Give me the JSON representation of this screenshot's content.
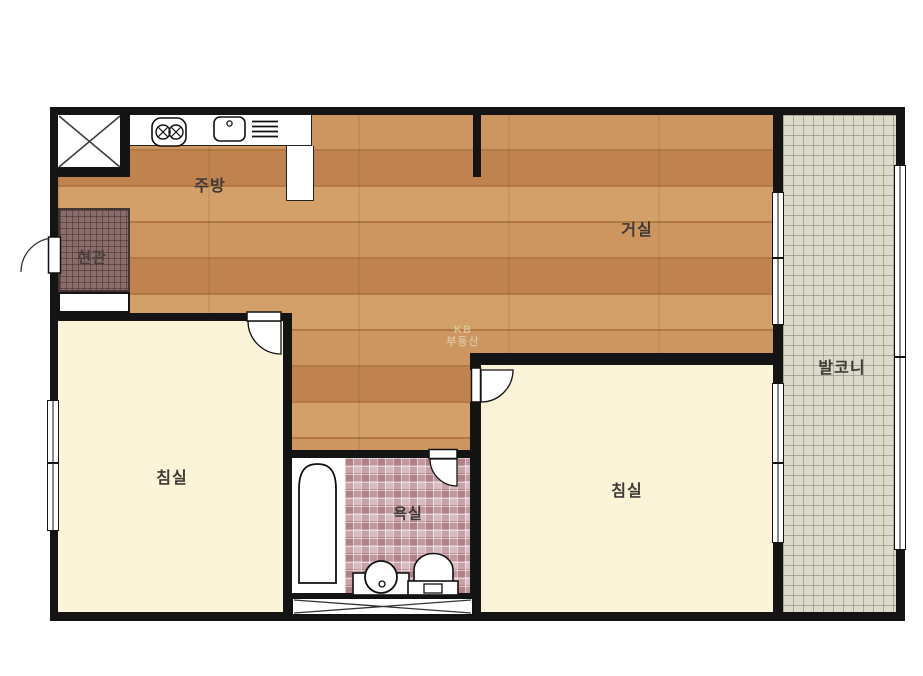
{
  "plan": {
    "rooms": {
      "kitchen": "주방",
      "living": "거실",
      "entrance": "현관",
      "bedroom_left": "침실",
      "bedroom_right": "침실",
      "bathroom": "욕실",
      "balcony": "발코니"
    },
    "watermark": {
      "line1": "KB",
      "line2": "부동산"
    },
    "icons": [
      "stove-icon",
      "sink-icon",
      "dish-rack-icon",
      "bathtub-icon",
      "washbasin-icon",
      "toilet-icon",
      "elevator-x-icon",
      "duct-x-icon",
      "door-swing-icon"
    ],
    "colors": {
      "wall": "#141414",
      "wood_floor": "#c1874e",
      "bedroom_floor": "#fbf4d8",
      "balcony_tile": "#dcdacb",
      "bathroom_tile": "#c59ca3",
      "entrance_tile": "#8a6c6a",
      "fixture_outline": "#111111",
      "label_text": "#3f3a36",
      "watermark_text": "#dcc9a2"
    }
  }
}
